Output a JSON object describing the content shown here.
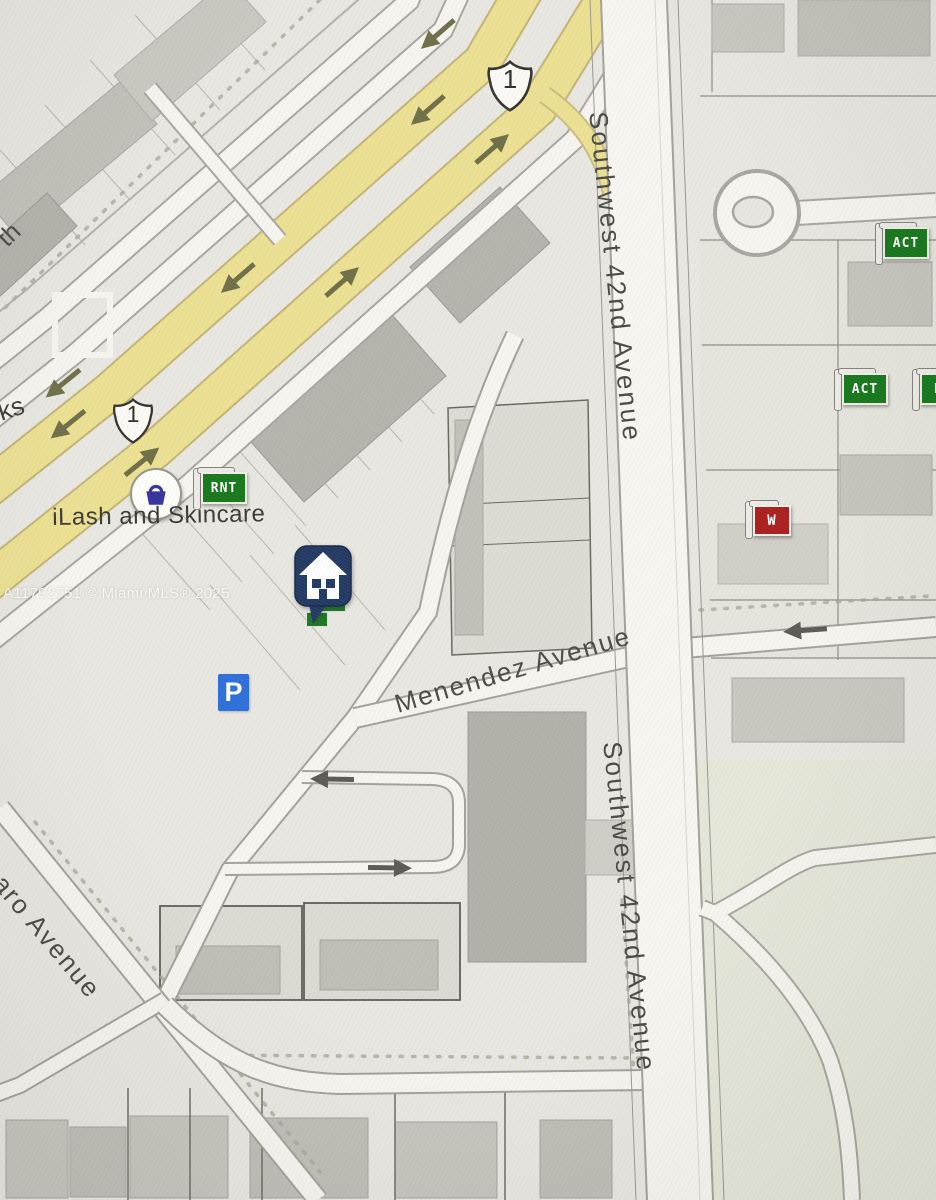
{
  "map": {
    "street_labels": [
      {
        "text": "Southwest 42nd Avenue"
      },
      {
        "text": "Southwest 42nd Avenue"
      },
      {
        "text": "Menendez Avenue"
      },
      {
        "text": "osaro Avenue"
      },
      {
        "text": "th"
      },
      {
        "text": "ks"
      }
    ],
    "poi": {
      "label": "iLash and Skincare"
    },
    "route_shields": [
      {
        "number": "1"
      },
      {
        "number": "1"
      }
    ],
    "listing_markers": {
      "subject": {
        "type": "house-marker",
        "color": "#223a63"
      },
      "flags": [
        {
          "label": "RNT",
          "color": "#17781c"
        },
        {
          "label": "ACT",
          "color": "#17781c"
        },
        {
          "label": "ACT",
          "color": "#17781c"
        },
        {
          "label": "RN",
          "color": "#17781c"
        },
        {
          "label": "W",
          "color": "#ab1f1f"
        }
      ]
    },
    "icons": {
      "parking_label": "P",
      "shopping_bag_color": "#34349e"
    },
    "watermark": "A11792751 © Miami MLS® 2025",
    "colors": {
      "highway_yellow": "#ece092",
      "road_white": "#f6f5f0",
      "land": "#e8e7e1",
      "arrow_olive": "#6f6f48",
      "parking_blue": "#2e6fd9",
      "green_area": "#e5e7d9"
    }
  }
}
